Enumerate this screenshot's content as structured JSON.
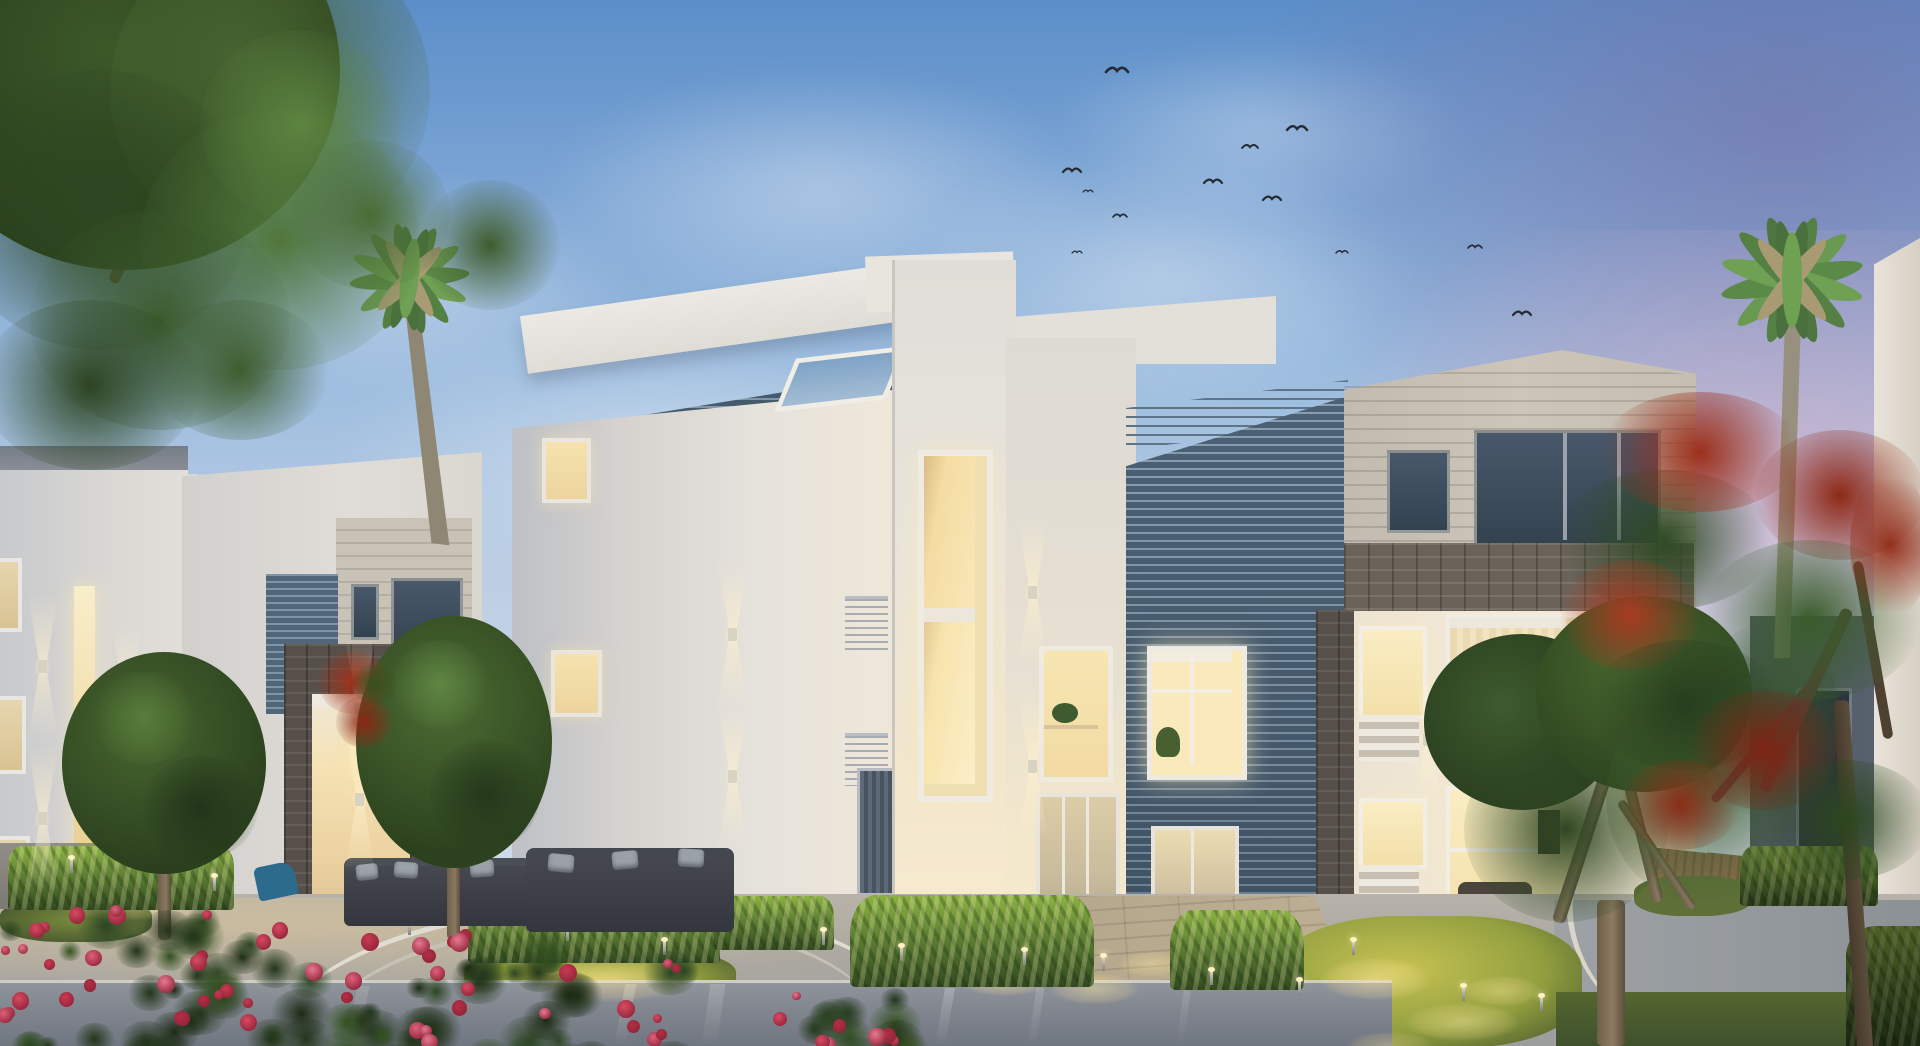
{
  "meta": {
    "type": "architectural-render",
    "description": "Dusk 3D rendering of a modern white residential compound: cubic villas with louvered facades and stone portals, warm lit windows, palm trees, a red flame tree, illuminated hedges and lawns, outdoor lounge sofas, rose bushes and a reflective plaza, birds flying in a blue-violet sky",
    "time_of_day": "dusk",
    "width": 1920,
    "height": 1046
  },
  "sky": {
    "top": "#5B8EC8",
    "mid": "#9FBEDF",
    "low": "#CBD7E7",
    "purple": "#8D84AF",
    "pink": "#DCB9CB"
  },
  "palette": {
    "facade_white": "#E9E5DF",
    "facade_warm": "#F3EAD8",
    "facade_shadow": "#C2C5CB",
    "louver_light": "#7E94A8",
    "louver_dark": "#4C6174",
    "stone": "#6B635A",
    "stone_dark": "#57504A",
    "beige_block": "#C8C1B5",
    "window_glow": "#F7E0A6",
    "window_glow_bright": "#FBEFC9",
    "window_dark": "#36444F",
    "lawn_lit": "#BDB94C",
    "lawn_dark": "#4C5C30",
    "hedge_lit": "#8DB244",
    "hedge_dark": "#314820",
    "tree_green": "#456330",
    "tree_dark": "#263A1B",
    "tree_light": "#5E8742",
    "flame_red": "#982E1A",
    "rose_red": "#D84A62",
    "pavement": "#ACA9A2",
    "pavement_warm": "#BBAD93",
    "reflect": "#7D838C",
    "sofa": "#383C43",
    "wood": "#8A6E4E",
    "bird": "#262B31",
    "trunk": "#76654F"
  },
  "birds": [
    {
      "x": 1117,
      "y": 72,
      "s": 1.1
    },
    {
      "x": 1297,
      "y": 130,
      "s": 1.0
    },
    {
      "x": 1250,
      "y": 148,
      "s": 0.8
    },
    {
      "x": 1072,
      "y": 172,
      "s": 0.9
    },
    {
      "x": 1088,
      "y": 192,
      "s": 0.5
    },
    {
      "x": 1213,
      "y": 183,
      "s": 0.9
    },
    {
      "x": 1272,
      "y": 200,
      "s": 0.9
    },
    {
      "x": 1120,
      "y": 217,
      "s": 0.7
    },
    {
      "x": 1077,
      "y": 253,
      "s": 0.5
    },
    {
      "x": 1342,
      "y": 253,
      "s": 0.6
    },
    {
      "x": 1475,
      "y": 248,
      "s": 0.7
    },
    {
      "x": 1522,
      "y": 315,
      "s": 0.9
    }
  ],
  "wall_sconces": [
    {
      "x": 38,
      "y": 660
    },
    {
      "x": 38,
      "y": 812
    },
    {
      "x": 122,
      "y": 693
    },
    {
      "x": 122,
      "y": 790
    },
    {
      "x": 355,
      "y": 703
    },
    {
      "x": 355,
      "y": 793
    },
    {
      "x": 728,
      "y": 628
    },
    {
      "x": 728,
      "y": 770
    },
    {
      "x": 1028,
      "y": 586
    },
    {
      "x": 1028,
      "y": 760
    },
    {
      "x": 1423,
      "y": 733
    }
  ],
  "spike_lights": [
    {
      "x": 70,
      "y": 858
    },
    {
      "x": 213,
      "y": 876
    },
    {
      "x": 408,
      "y": 920
    },
    {
      "x": 566,
      "y": 926
    },
    {
      "x": 663,
      "y": 940
    },
    {
      "x": 822,
      "y": 930
    },
    {
      "x": 900,
      "y": 946
    },
    {
      "x": 1023,
      "y": 950
    },
    {
      "x": 1102,
      "y": 956
    },
    {
      "x": 1210,
      "y": 970
    },
    {
      "x": 1298,
      "y": 980
    },
    {
      "x": 1352,
      "y": 940
    },
    {
      "x": 1462,
      "y": 986
    },
    {
      "x": 1540,
      "y": 996
    }
  ],
  "light_pools": [
    {
      "x": 30,
      "y": 884,
      "w": 190,
      "h": 42,
      "o": 0.55
    },
    {
      "x": 500,
      "y": 950,
      "w": 220,
      "h": 60,
      "o": 0.6
    },
    {
      "x": 860,
      "y": 938,
      "w": 150,
      "h": 50,
      "o": 0.55
    },
    {
      "x": 940,
      "y": 956,
      "w": 130,
      "h": 46,
      "o": 0.65
    },
    {
      "x": 1035,
      "y": 968,
      "w": 120,
      "h": 42,
      "o": 0.55
    },
    {
      "x": 1105,
      "y": 946,
      "w": 95,
      "h": 36,
      "o": 0.5
    },
    {
      "x": 1300,
      "y": 950,
      "w": 150,
      "h": 58,
      "o": 0.65
    },
    {
      "x": 1385,
      "y": 996,
      "w": 155,
      "h": 52,
      "o": 0.55
    },
    {
      "x": 1330,
      "y": 1026,
      "w": 120,
      "h": 42,
      "o": 0.45
    },
    {
      "x": 1450,
      "y": 970,
      "w": 105,
      "h": 42,
      "o": 0.5
    },
    {
      "x": 320,
      "y": 700,
      "w": 90,
      "h": 120,
      "o": 0.25
    }
  ],
  "reflection_streaks": [
    {
      "x": 620,
      "y": 984,
      "w": 11,
      "h": 60,
      "o": 0.35,
      "skew": -10
    },
    {
      "x": 706,
      "y": 984,
      "w": 15,
      "h": 62,
      "o": 0.25,
      "skew": -8
    },
    {
      "x": 940,
      "y": 988,
      "w": 10,
      "h": 58,
      "o": 0.3,
      "skew": -10
    },
    {
      "x": 1032,
      "y": 988,
      "w": 8,
      "h": 58,
      "o": 0.22,
      "skew": -9
    },
    {
      "x": 1180,
      "y": 990,
      "w": 7,
      "h": 54,
      "o": 0.18,
      "skew": -8
    },
    {
      "x": 352,
      "y": 986,
      "w": 12,
      "h": 56,
      "o": 0.2,
      "skew": -11
    }
  ],
  "rose_clusters": [
    {
      "x": -10,
      "y": 900,
      "w": 300,
      "h": 146,
      "flowers": 26
    },
    {
      "x": 300,
      "y": 928,
      "w": 380,
      "h": 118,
      "flowers": 24
    },
    {
      "x": 770,
      "y": 988,
      "w": 130,
      "h": 58,
      "flowers": 8
    }
  ],
  "counts": {
    "birds": 12,
    "palm_trees": 2,
    "round_trees": 3,
    "flame_trees": 1,
    "buildings": 5
  }
}
